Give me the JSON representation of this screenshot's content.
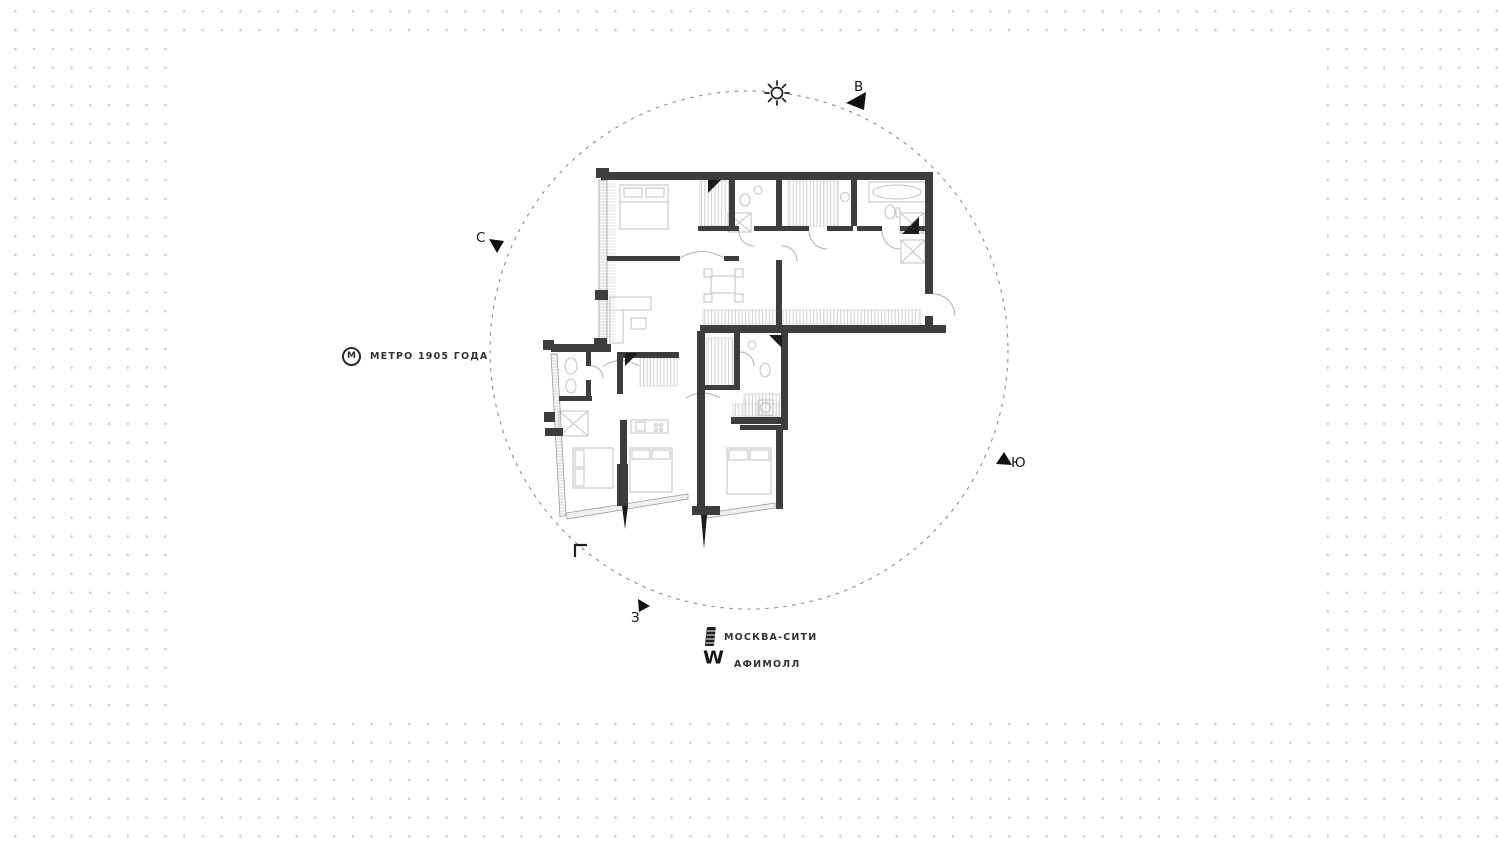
{
  "scene": {
    "type": "apartment floor plan with orientation compass",
    "colors": {
      "dot_grid": "#c9c9c9",
      "panel": "#ffffff",
      "wall": "#3d3d3d",
      "furniture": "#c2c2c2",
      "compass_circle": "#8c8c8c",
      "text": "#2e2e2e"
    }
  },
  "compass": {
    "east": "В",
    "north": "С",
    "south": "Ю",
    "west": "З",
    "sun_icon": "sun"
  },
  "landmarks": {
    "metro": {
      "icon_letter": "М",
      "label": "МЕТРО 1905 ГОДА"
    },
    "moscow_city": {
      "label": "МОСКВА-СИТИ"
    },
    "afimall": {
      "icon_glyph": "W",
      "label": "АФИМОЛЛ"
    }
  }
}
